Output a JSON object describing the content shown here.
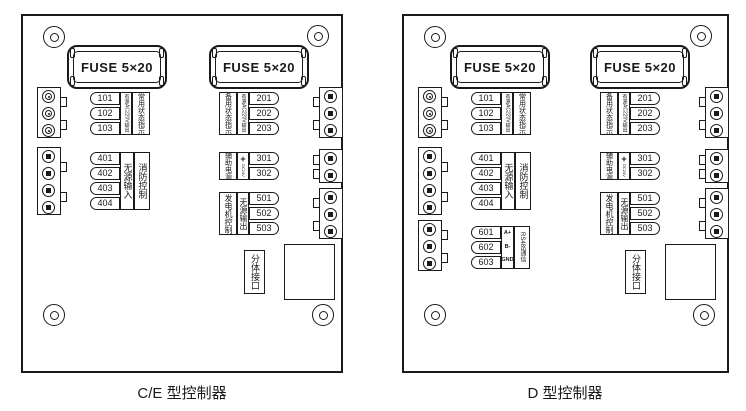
{
  "colors": {
    "line": "#1a1a1a",
    "background": "#ffffff"
  },
  "fuse_label": "FUSE 5×20",
  "boards": [
    {
      "caption": "C/E 型控制器",
      "split_port_label": "分体接口",
      "terminal_groups": [
        {
          "id": "g101",
          "terminals": [
            "101",
            "102",
            "103"
          ],
          "function_labels": [
            "有源AC220V输出",
            "常用状态指示"
          ]
        },
        {
          "id": "g401",
          "terminals": [
            "401",
            "402",
            "403",
            "404"
          ],
          "function_labels": [
            "无源输入",
            "消防控制"
          ]
        },
        {
          "id": "g201",
          "terminals": [
            "201",
            "202",
            "203"
          ],
          "function_labels": [
            "备用状态指示",
            "有源AC220V输出"
          ]
        },
        {
          "id": "g301",
          "terminals": [
            "301",
            "302"
          ],
          "function_labels": [
            "辅助电源"
          ],
          "polarity": {
            "plus": "+",
            "mid": "DC24V",
            "minus": "−"
          }
        },
        {
          "id": "g501",
          "terminals": [
            "501",
            "502",
            "503"
          ],
          "function_labels": [
            "发电机控制",
            "无源输出"
          ]
        }
      ],
      "connectors": {
        "left": [
          {
            "pins": 3,
            "style": "ring"
          },
          {
            "pins": 4,
            "style": "square"
          }
        ],
        "right": [
          {
            "pins": 3,
            "style": "square"
          },
          {
            "pins": 2,
            "style": "square"
          },
          {
            "pins": 3,
            "style": "square"
          }
        ]
      }
    },
    {
      "caption": "D 型控制器",
      "split_port_label": "分体接口",
      "terminal_groups": [
        {
          "id": "g101",
          "terminals": [
            "101",
            "102",
            "103"
          ],
          "function_labels": [
            "有源AC220V输出",
            "常用状态指示"
          ]
        },
        {
          "id": "g401",
          "terminals": [
            "401",
            "402",
            "403",
            "404"
          ],
          "function_labels": [
            "无源输入",
            "消防控制"
          ]
        },
        {
          "id": "g601",
          "terminals": [
            "601",
            "602",
            "603"
          ],
          "pin_names": [
            "A+",
            "B-",
            "GND"
          ],
          "function_labels": [
            "RS485通信"
          ]
        },
        {
          "id": "g201",
          "terminals": [
            "201",
            "202",
            "203"
          ],
          "function_labels": [
            "备用状态指示",
            "有源AC220V输出"
          ]
        },
        {
          "id": "g301",
          "terminals": [
            "301",
            "302"
          ],
          "function_labels": [
            "辅助电源"
          ],
          "polarity": {
            "plus": "+",
            "mid": "DC24V",
            "minus": "−"
          }
        },
        {
          "id": "g501",
          "terminals": [
            "501",
            "502",
            "503"
          ],
          "function_labels": [
            "发电机控制",
            "无源输出"
          ]
        }
      ],
      "connectors": {
        "left": [
          {
            "pins": 3,
            "style": "ring"
          },
          {
            "pins": 4,
            "style": "square"
          },
          {
            "pins": 3,
            "style": "square"
          }
        ],
        "right": [
          {
            "pins": 3,
            "style": "square"
          },
          {
            "pins": 2,
            "style": "square"
          },
          {
            "pins": 3,
            "style": "square"
          }
        ]
      }
    }
  ]
}
